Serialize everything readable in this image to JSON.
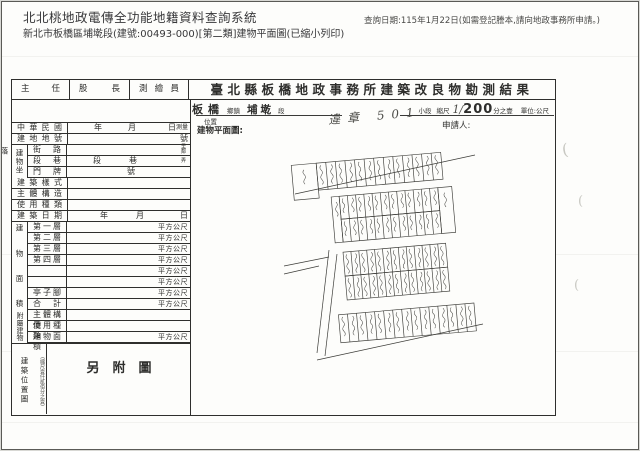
{
  "header": {
    "system_title": "北北桃地政電傳全功能地籍資料查詢系統",
    "subtitle": "新北市板橋區埔墘段(建號:00493-000)[第二類]建物平面圖(已縮小列印)",
    "query_date": "查詢日期:115年1月22日(如需登記謄本,請向地政事務所申請。)"
  },
  "approval": {
    "chief": "主任",
    "section_chief": "股長",
    "surveyor": "測繪員"
  },
  "form_title": "臺北縣板橋地政事務所建築改良物勘測結果",
  "location_line": {
    "district": "板橋",
    "district_suffix": "鄉鎮",
    "section": "埔墘",
    "section_suffix": "段",
    "subsection_label": "小段",
    "scale_label": "縮尺",
    "scale_hand": "1/",
    "scale_value": "200",
    "scale_suffix": "分之壹",
    "unit_label": "單位:公尺"
  },
  "plan_label": {
    "line1": "位置",
    "line2": "建物平面圖:"
  },
  "handwritten_note": "違章 501",
  "applicant_label": "申請人:",
  "form": {
    "row_minguo": {
      "label": "中華民國",
      "y": "年",
      "m": "月",
      "d": "日",
      "suffix": "測量"
    },
    "row_lot": {
      "label": "建地地號",
      "right": "號"
    },
    "group_location": {
      "label": "建物坐落",
      "street": {
        "label": "街路",
        "tiny": "里鄰"
      },
      "lane": {
        "label": "段巷",
        "seg": "段",
        "lane": "巷",
        "tiny": "弄"
      },
      "door": {
        "label": "門牌",
        "val": "號"
      }
    },
    "row_style": {
      "label": "建築樣式"
    },
    "row_structure": {
      "label": "主體構造"
    },
    "row_usage": {
      "label": "使用種類"
    },
    "row_builddate": {
      "label": "建築日期",
      "y": "年",
      "m": "月",
      "d": "日"
    },
    "group_area": {
      "label": "建物面積",
      "floors": [
        "第一層",
        "第二層",
        "第三層",
        "第四層",
        "",
        "",
        "亭子腳",
        "合計"
      ]
    },
    "group_attached": {
      "label": "附屬建物",
      "rows": [
        "主體構造",
        "使用種類",
        "建物面積"
      ]
    },
    "unit": "平方公尺"
  },
  "location_map_box": {
    "label": "建築位置圖",
    "note": "(縮尺壹仟貳佰分之壹)",
    "content": "另附圖"
  }
}
